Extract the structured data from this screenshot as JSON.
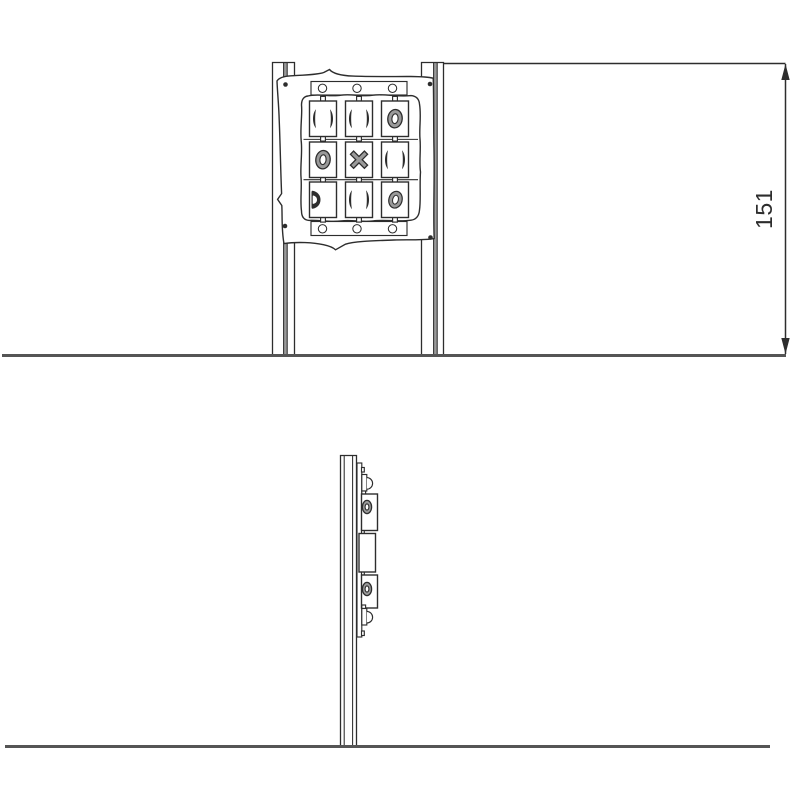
{
  "dimension": {
    "value": "151"
  },
  "colors": {
    "line": "#2d2d2d",
    "ground": "#555555",
    "glyph": "#9a9a9a",
    "paper": "#ffffff"
  },
  "front_view": {
    "grid_rows": 3,
    "grid_cols": 3,
    "grid_cells": [
      [
        "edge-on",
        "edge-on",
        "O"
      ],
      [
        "O",
        "X",
        "edge-on"
      ],
      [
        "half-ring",
        "edge-on",
        "O"
      ]
    ],
    "mounting_holes_top": 3,
    "mounting_holes_bottom": 3,
    "corner_screws": 4
  },
  "side_view": {
    "protruding_blocks": 3,
    "visible_rings": 2
  }
}
